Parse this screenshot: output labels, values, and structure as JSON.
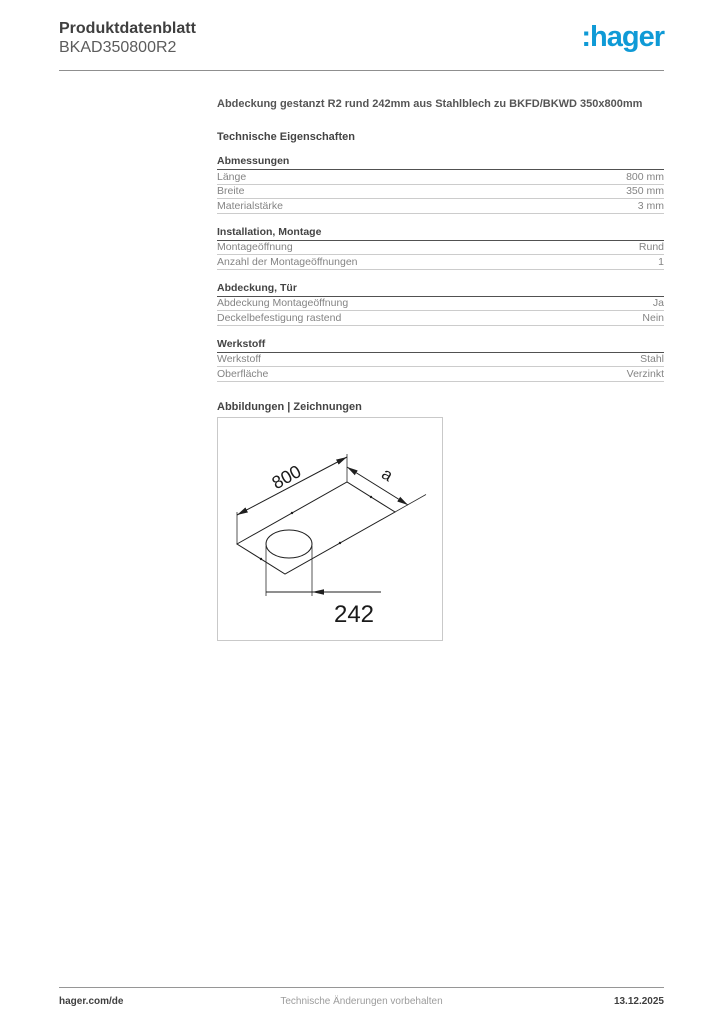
{
  "header": {
    "title": "Produktdatenblatt",
    "product_code": "BKAD350800R2",
    "logo_text": ":hager",
    "logo_color": "#0f9ad6"
  },
  "description": "Abdeckung gestanzt R2 rund 242mm aus Stahlblech zu BKFD/BKWD 350x800mm",
  "section_title": "Technische Eigenschaften",
  "tables": [
    {
      "title": "Abmessungen",
      "rows": [
        [
          "Länge",
          "800 mm"
        ],
        [
          "Breite",
          "350 mm"
        ],
        [
          "Materialstärke",
          "3 mm"
        ]
      ]
    },
    {
      "title": "Installation, Montage",
      "rows": [
        [
          "Montageöffnung",
          "Rund"
        ],
        [
          "Anzahl der Montageöffnungen",
          "1"
        ]
      ]
    },
    {
      "title": "Abdeckung, Tür",
      "rows": [
        [
          "Abdeckung Montageöffnung",
          "Ja"
        ],
        [
          "Deckelbefestigung rastend",
          "Nein"
        ]
      ]
    },
    {
      "title": "Werkstoff",
      "rows": [
        [
          "Werkstoff",
          "Stahl"
        ],
        [
          "Oberfläche",
          "Verzinkt"
        ]
      ]
    }
  ],
  "drawings_title": "Abbildungen | Zeichnungen",
  "drawing": {
    "dim_length": "800",
    "dim_width": "a",
    "dim_hole": "242"
  },
  "footer": {
    "left": "hager.com/de",
    "center": "Technische Änderungen vorbehalten",
    "right": "13.12.2025"
  }
}
